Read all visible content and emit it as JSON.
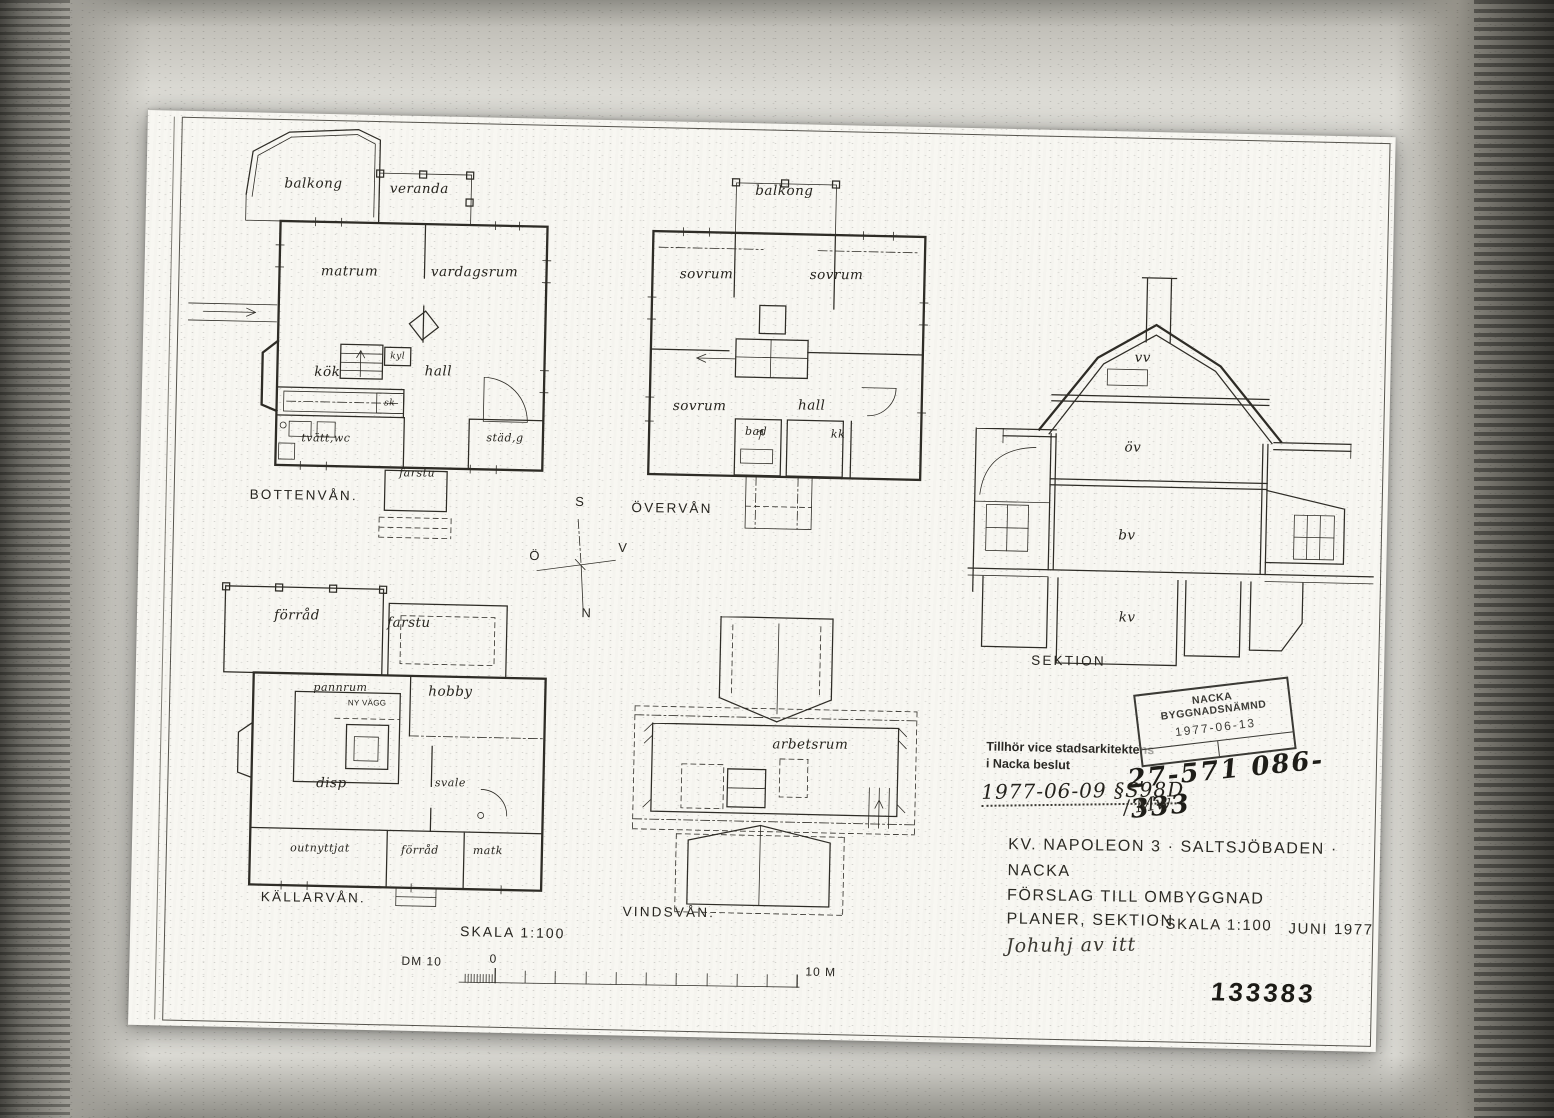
{
  "colors": {
    "ink": "#2e2c26",
    "paper": "#f8f7f2"
  },
  "plans": {
    "bottenvan": {
      "caption": "BOTTENVÅN.",
      "rooms": {
        "balkong": "balkong",
        "veranda": "veranda",
        "matrum": "matrum",
        "vardagsrum": "vardagsrum",
        "kyl": "kyl",
        "kok": "kök",
        "hall": "hall",
        "sk": "sk",
        "tvatt_wc": "tvätt,wc",
        "stad_g": "städ,g",
        "farstu": "farstu"
      }
    },
    "overvan": {
      "caption": "ÖVERVÅN",
      "rooms": {
        "balkong": "balkong",
        "sovrum_nw": "sovrum",
        "sovrum_ne": "sovrum",
        "sovrum_sw": "sovrum",
        "hall": "hall",
        "bad": "bad",
        "kk": "kk"
      }
    },
    "kallarvan": {
      "caption": "KÄLLARVÅN.",
      "rooms": {
        "forrad": "förråd",
        "farstu": "farstu",
        "pannrum": "pannrum",
        "ny_vagg": "NY VÄGG",
        "hobby": "hobby",
        "disp": "disp",
        "svale": "svale",
        "outnyttjat": "outnyttjat",
        "forrad2": "förråd",
        "matk": "matk"
      }
    },
    "vindsvan": {
      "caption": "VINDSVÅN.",
      "rooms": {
        "arbetsrum": "arbetsrum"
      }
    },
    "sektion": {
      "caption": "SEKTION",
      "levels": {
        "vv": "vv",
        "ov": "öv",
        "bv": "bv",
        "kv": "kv"
      }
    }
  },
  "compass": {
    "south": "S",
    "east": "Ö",
    "west": "V",
    "north": "N"
  },
  "scalebar": {
    "title": "SKALA 1:100",
    "dm_label": "DM 10",
    "zero": "0",
    "end_label": "10 M"
  },
  "stamps": {
    "board_name": "NACKA BYGGNADSNÄMND",
    "board_date": "1977-06-13",
    "case_number": "27-571 086-333",
    "note_line1": "Tillhör vice stadsarkitektens",
    "note_line2": "i Nacka beslut",
    "approval_date": "1977-06-09 §S98D",
    "initials": "/ Mw"
  },
  "title_block": {
    "line1": "KV. NAPOLEON 3 · SALTSJÖBADEN ·",
    "line2": "NACKA",
    "line3": "FÖRSLAG TILL OMBYGGNAD",
    "line4": "PLANER, SEKTION",
    "scale": "SKALA 1:100",
    "date": "JUNI 1977",
    "signature": "Johuhj av itt"
  },
  "archive_number": "133383"
}
